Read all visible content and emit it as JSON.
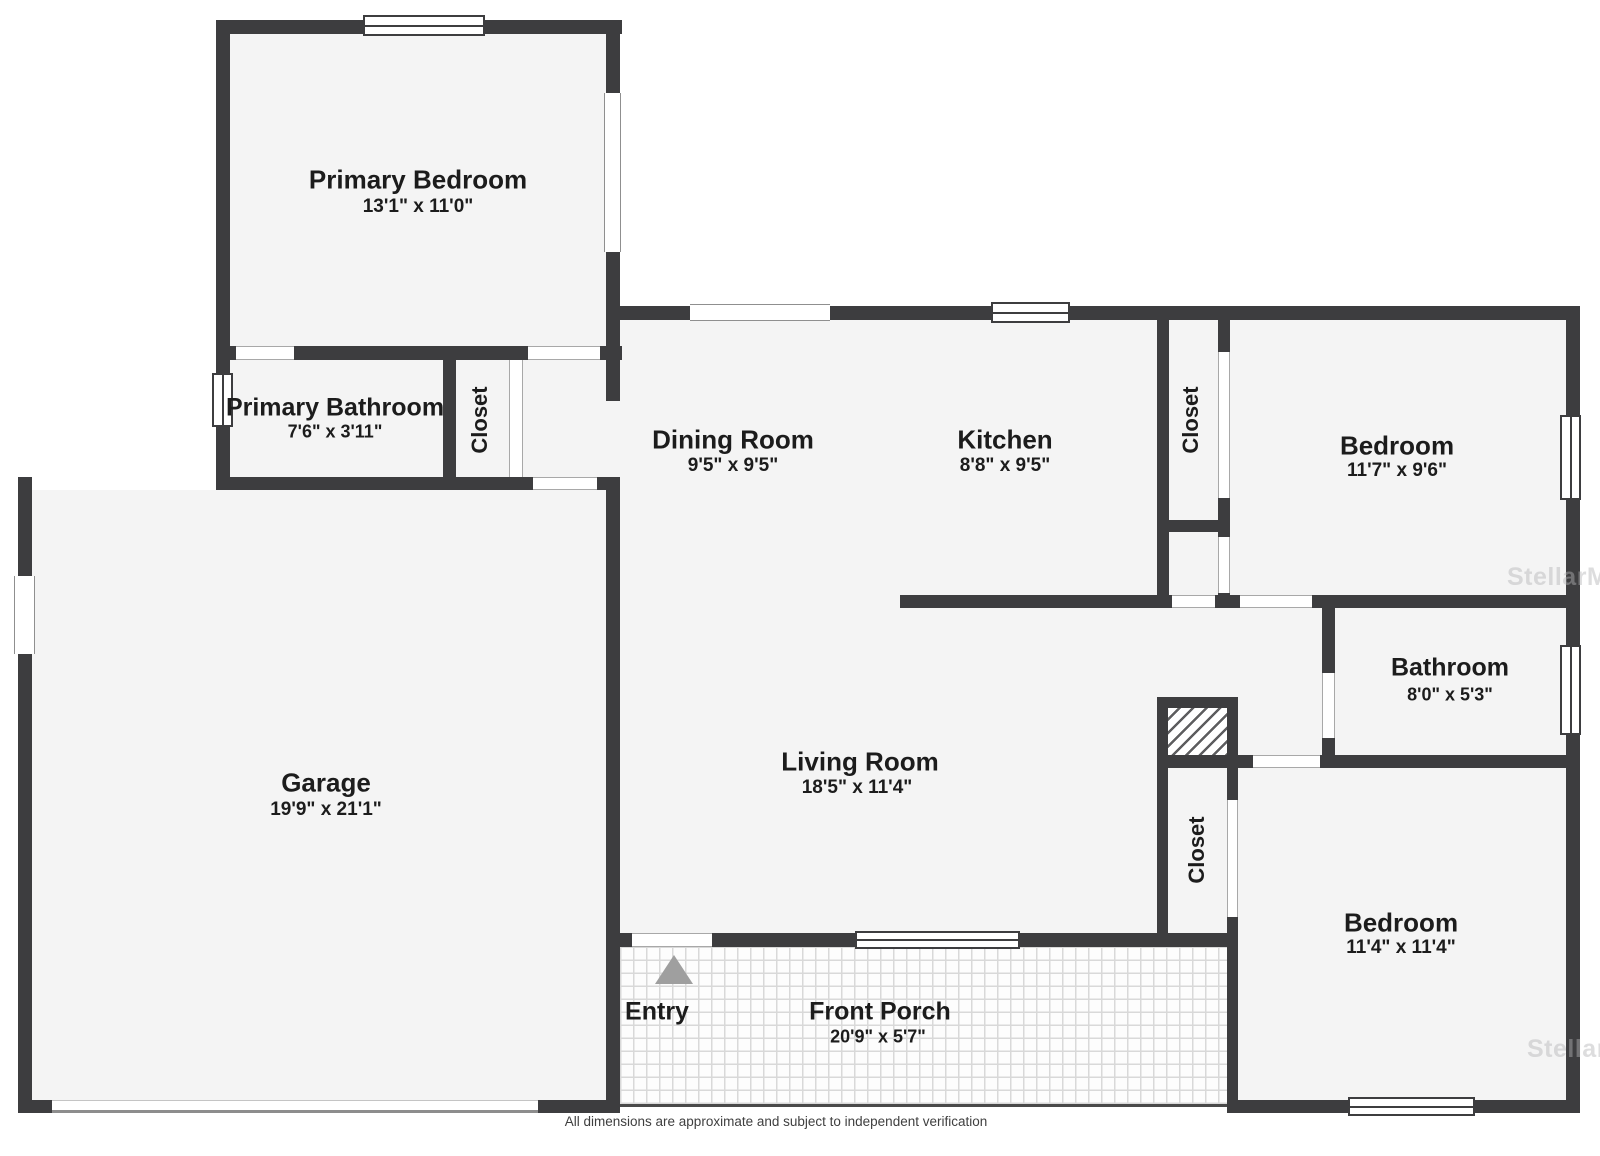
{
  "floorplan": {
    "rooms": {
      "primary_bedroom": {
        "name": "Primary Bedroom",
        "dims": "13'1\" x 11'0\""
      },
      "primary_bathroom": {
        "name": "Primary Bathroom",
        "dims": "7'6\" x 3'11\""
      },
      "closet_primary": {
        "name": "Closet"
      },
      "dining_room": {
        "name": "Dining Room",
        "dims": "9'5\" x 9'5\""
      },
      "kitchen": {
        "name": "Kitchen",
        "dims": "8'8\" x 9'5\""
      },
      "closet_kitchen": {
        "name": "Closet"
      },
      "bedroom_right": {
        "name": "Bedroom",
        "dims": "11'7\" x 9'6\""
      },
      "garage": {
        "name": "Garage",
        "dims": "19'9\" x 21'1\""
      },
      "living_room": {
        "name": "Living Room",
        "dims": "18'5\" x 11'4\""
      },
      "bathroom": {
        "name": "Bathroom",
        "dims": "8'0\" x 5'3\""
      },
      "closet_hall": {
        "name": "Closet"
      },
      "bedroom_bottom": {
        "name": "Bedroom",
        "dims": "11'4\" x 11'4\""
      },
      "entry": {
        "name": "Entry"
      },
      "front_porch": {
        "name": "Front Porch",
        "dims": "20'9\" x 5'7\""
      }
    },
    "watermark": "StellarMLS",
    "footer": "All dimensions are approximate and subject to independent verification",
    "colors": {
      "wall": "#3d3d3f",
      "floor": "#f4f4f4",
      "background": "#ffffff",
      "label_text": "#1c1c1c",
      "entry_arrow": "#9f9f9f",
      "watermark": "#b4b4b6"
    }
  }
}
